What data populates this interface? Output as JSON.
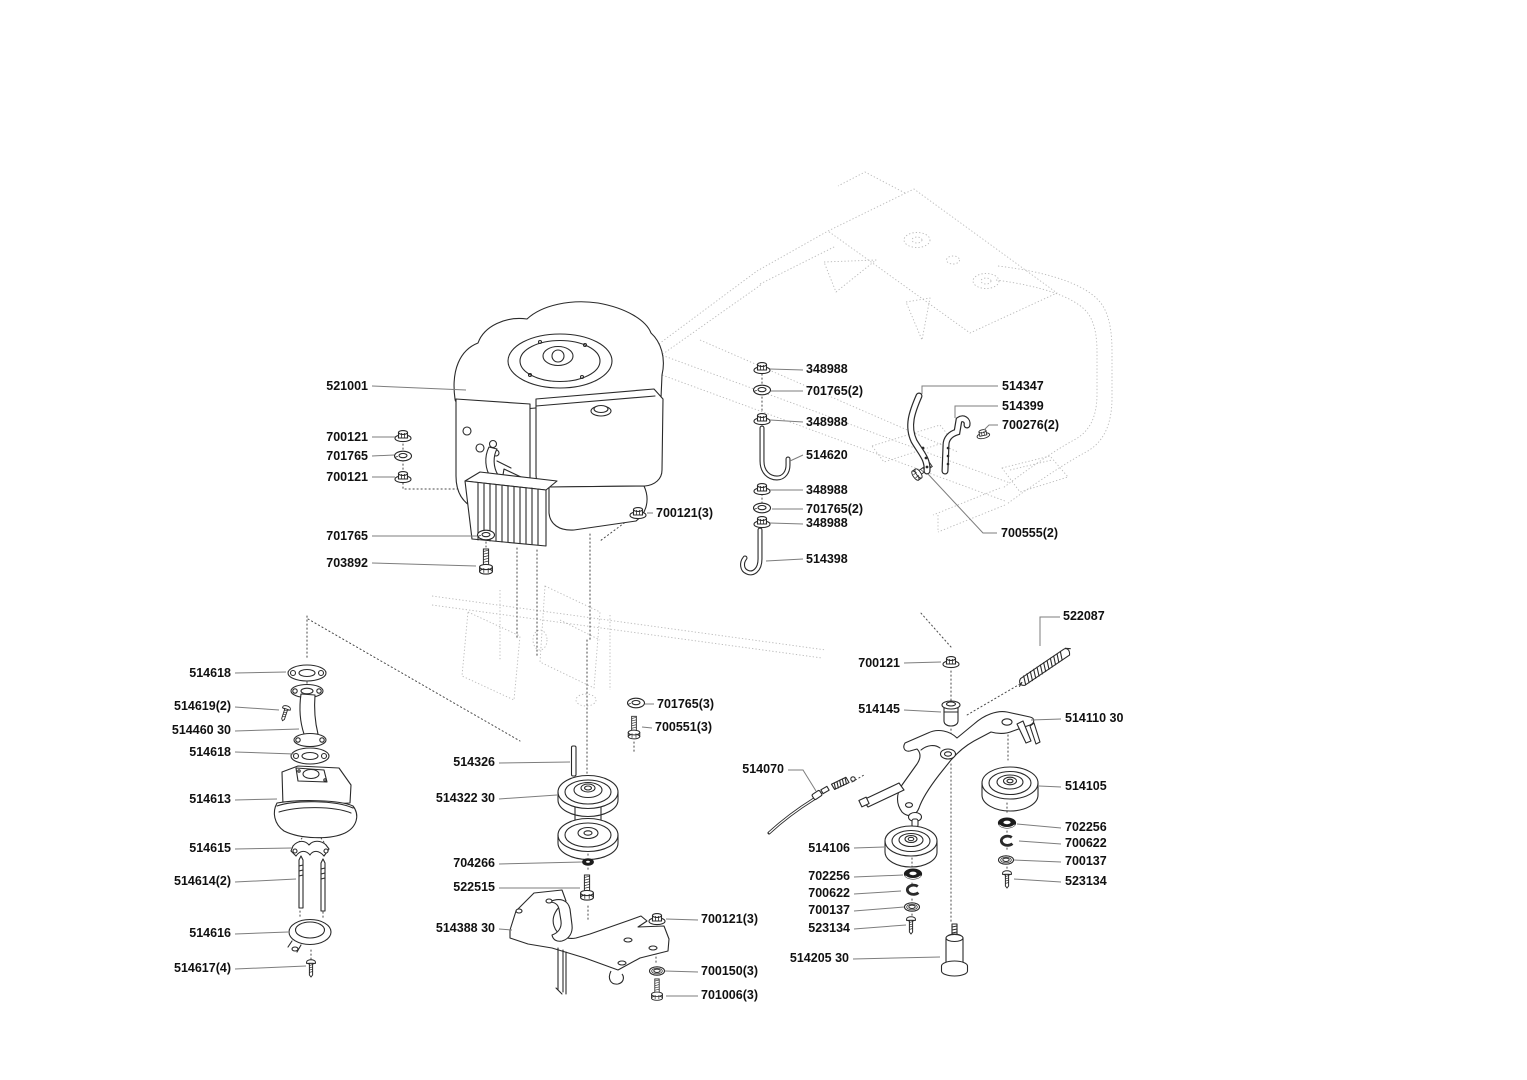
{
  "diagram": {
    "kind": "exploded-parts-diagram",
    "colors": {
      "background": "#ffffff",
      "line": "#2a2a2a",
      "leader": "#7d7d7d",
      "ghost": "#b9b9b9",
      "label_text": "#111111"
    },
    "labels": [
      {
        "text": "521001"
      },
      {
        "text": "700121"
      },
      {
        "text": "701765"
      },
      {
        "text": "700121"
      },
      {
        "text": "701765"
      },
      {
        "text": "703892"
      },
      {
        "text": "348988"
      },
      {
        "text": "701765(2)"
      },
      {
        "text": "348988"
      },
      {
        "text": "514620"
      },
      {
        "text": "348988"
      },
      {
        "text": "701765(2)"
      },
      {
        "text": "348988"
      },
      {
        "text": "514398"
      },
      {
        "text": "700121(3)"
      },
      {
        "text": "514347"
      },
      {
        "text": "514399"
      },
      {
        "text": "700276(2)"
      },
      {
        "text": "700555(2)"
      },
      {
        "text": "514618"
      },
      {
        "text": "514619(2)"
      },
      {
        "text": "514460 30"
      },
      {
        "text": "514618"
      },
      {
        "text": "514613"
      },
      {
        "text": "514615"
      },
      {
        "text": "514614(2)"
      },
      {
        "text": "514616"
      },
      {
        "text": "514617(4)"
      },
      {
        "text": "701765(3)"
      },
      {
        "text": "700551(3)"
      },
      {
        "text": "514326"
      },
      {
        "text": "514322 30"
      },
      {
        "text": "704266"
      },
      {
        "text": "522515"
      },
      {
        "text": "514388 30"
      },
      {
        "text": "700121(3)"
      },
      {
        "text": "700150(3)"
      },
      {
        "text": "701006(3)"
      },
      {
        "text": "522087"
      },
      {
        "text": "700121"
      },
      {
        "text": "514145"
      },
      {
        "text": "514110 30"
      },
      {
        "text": "514070"
      },
      {
        "text": "514105"
      },
      {
        "text": "702256"
      },
      {
        "text": "700622"
      },
      {
        "text": "700137"
      },
      {
        "text": "523134"
      },
      {
        "text": "514106"
      },
      {
        "text": "702256"
      },
      {
        "text": "700622"
      },
      {
        "text": "700137"
      },
      {
        "text": "523134"
      },
      {
        "text": "514205 30"
      }
    ]
  }
}
